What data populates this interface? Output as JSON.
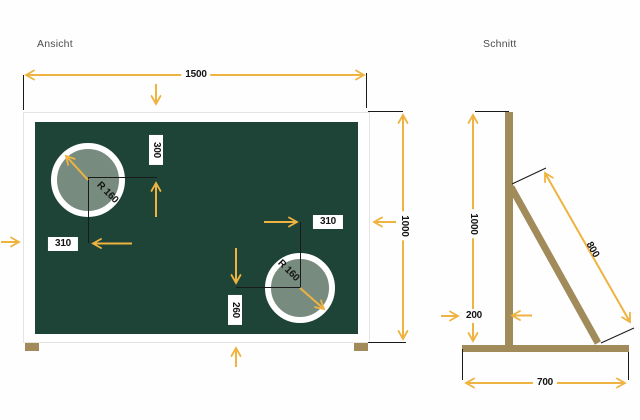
{
  "colors": {
    "board_green": "#1e4337",
    "hole_fill": "#778b7e",
    "dimension_yellow": "#eeb340",
    "wood_tan": "#a18b5a"
  },
  "views": {
    "ansicht": {
      "title": "Ansicht",
      "dimensions": {
        "board_width": "1500",
        "board_height": "1000",
        "hole1_top_offset": "300",
        "hole1_left_offset": "310",
        "hole1_radius": "R 160",
        "hole2_top_offset": "310",
        "hole2_bottom_offset": "260",
        "hole2_radius": "R 160"
      }
    },
    "schnitt": {
      "title": "Schnitt",
      "dimensions": {
        "height": "1000",
        "base_front_offset": "200",
        "strut_length": "800",
        "base_depth": "700"
      }
    }
  }
}
